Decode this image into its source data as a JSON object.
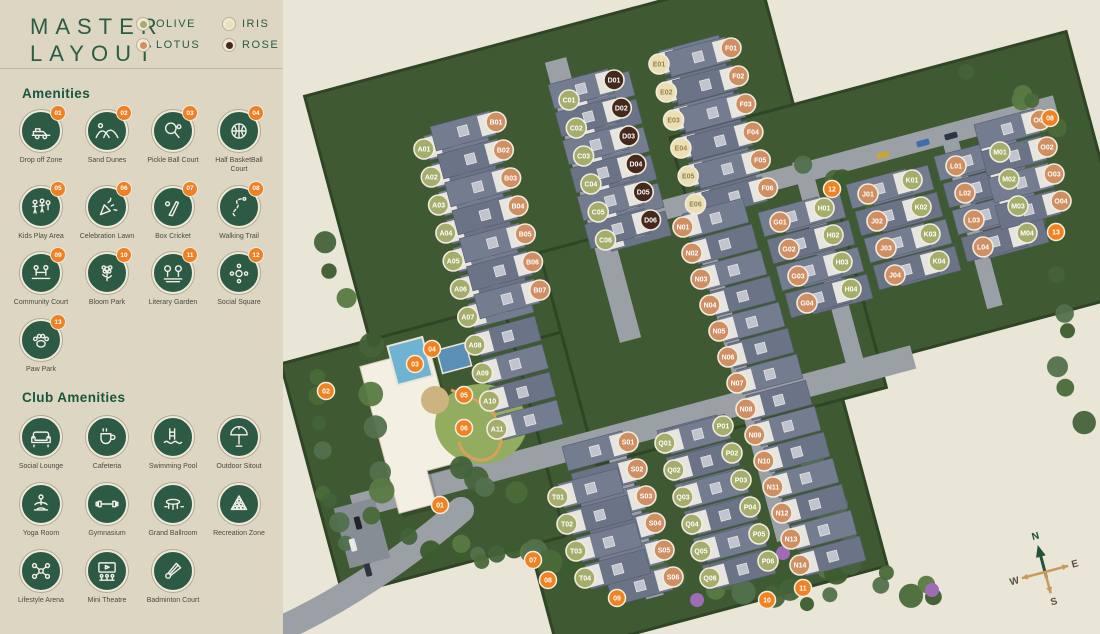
{
  "title": {
    "line1": "MASTER",
    "line2": "LAYOUT"
  },
  "legend": {
    "items": [
      {
        "label": "OLIVE",
        "color": "#a4ad6b"
      },
      {
        "label": "IRIS",
        "color": "#ecdfb4"
      },
      {
        "label": "LOTUS",
        "color": "#cf8f63"
      },
      {
        "label": "ROSE",
        "color": "#45291c"
      }
    ]
  },
  "amenities": {
    "heading": "Amenities",
    "items": [
      {
        "num": "01",
        "label": "Drop off Zone",
        "icon": "car"
      },
      {
        "num": "02",
        "label": "Sand Dunes",
        "icon": "dunes"
      },
      {
        "num": "03",
        "label": "Pickle Ball Court",
        "icon": "paddle"
      },
      {
        "num": "04",
        "label": "Half BasketBall Court",
        "icon": "basketball"
      },
      {
        "num": "05",
        "label": "Kids Play Area",
        "icon": "kids"
      },
      {
        "num": "06",
        "label": "Celebration Lawn",
        "icon": "party"
      },
      {
        "num": "07",
        "label": "Box Cricket",
        "icon": "cricket"
      },
      {
        "num": "08",
        "label": "Walking Trail",
        "icon": "trail"
      },
      {
        "num": "09",
        "label": "Community Court",
        "icon": "community"
      },
      {
        "num": "10",
        "label": "Bloom Park",
        "icon": "flower"
      },
      {
        "num": "11",
        "label": "Literary Garden",
        "icon": "garden"
      },
      {
        "num": "12",
        "label": "Social Square",
        "icon": "social"
      },
      {
        "num": "13",
        "label": "Paw Park",
        "icon": "paw"
      }
    ]
  },
  "club_amenities": {
    "heading": "Club Amenities",
    "items": [
      {
        "label": "Social Lounge",
        "icon": "sofa"
      },
      {
        "label": "Cafeteria",
        "icon": "cafe"
      },
      {
        "label": "Swimming Pool",
        "icon": "pool"
      },
      {
        "label": "Outdoor Sitout",
        "icon": "umbrella"
      },
      {
        "label": "Yoga Room",
        "icon": "yoga"
      },
      {
        "label": "Gymnasium",
        "icon": "dumbbell"
      },
      {
        "label": "Grand Ballroom",
        "icon": "ballroom"
      },
      {
        "label": "Recreation Zone",
        "icon": "billiards"
      },
      {
        "label": "Lifestyle Arena",
        "icon": "nodes"
      },
      {
        "label": "Mini Theatre",
        "icon": "theatre"
      },
      {
        "label": "Badminton Court",
        "icon": "shuttle"
      }
    ]
  },
  "map": {
    "background": "#e9e5d7",
    "unit_colors": {
      "olive": "#a4ad6b",
      "lotus": "#cf8f63",
      "iris": "#ecdfb4",
      "rose": "#45291c"
    },
    "clusters": [
      {
        "id": "A",
        "color": "olive",
        "count": 11,
        "x": 141,
        "y": 149,
        "dx": 7.3,
        "dy": 28,
        "side": 1
      },
      {
        "id": "B",
        "color": "lotus",
        "count": 7,
        "x": 213,
        "y": 122,
        "dx": 7.3,
        "dy": 28,
        "side": -1
      },
      {
        "id": "C",
        "color": "olive",
        "count": 6,
        "x": 286,
        "y": 100,
        "dx": 7.3,
        "dy": 28,
        "side": 1
      },
      {
        "id": "D",
        "color": "rose",
        "count": 6,
        "x": 331,
        "y": 80,
        "dx": 7.3,
        "dy": 28,
        "side": -1
      },
      {
        "id": "E",
        "color": "iris",
        "count": 6,
        "x": 376,
        "y": 64,
        "dx": 7.3,
        "dy": 28,
        "side": 1
      },
      {
        "id": "F",
        "color": "lotus",
        "count": 6,
        "x": 448,
        "y": 48,
        "dx": 7.3,
        "dy": 28,
        "side": -1
      },
      {
        "id": "G",
        "color": "lotus",
        "count": 4,
        "x": 497,
        "y": 222,
        "dx": 9,
        "dy": 27,
        "side": 1
      },
      {
        "id": "H",
        "color": "olive",
        "count": 4,
        "x": 541,
        "y": 208,
        "dx": 9,
        "dy": 27,
        "side": -1
      },
      {
        "id": "J",
        "color": "lotus",
        "count": 4,
        "x": 585,
        "y": 194,
        "dx": 9,
        "dy": 27,
        "side": 1
      },
      {
        "id": "K",
        "color": "olive",
        "count": 4,
        "x": 629,
        "y": 180,
        "dx": 9,
        "dy": 27,
        "side": -1
      },
      {
        "id": "L",
        "color": "lotus",
        "count": 4,
        "x": 673,
        "y": 166,
        "dx": 9,
        "dy": 27,
        "side": 1
      },
      {
        "id": "M",
        "color": "olive",
        "count": 4,
        "x": 717,
        "y": 152,
        "dx": 9,
        "dy": 27,
        "side": -1
      },
      {
        "id": "O",
        "color": "lotus",
        "count": 4,
        "x": 757,
        "y": 120,
        "dx": 7,
        "dy": 27,
        "side": -1
      },
      {
        "id": "N",
        "color": "lotus",
        "count": 14,
        "x": 400,
        "y": 227,
        "dx": 9,
        "dy": 26,
        "side": 1
      },
      {
        "id": "P",
        "color": "olive",
        "count": 6,
        "x": 440,
        "y": 426,
        "dx": 9,
        "dy": 27,
        "side": -1
      },
      {
        "id": "Q",
        "color": "olive",
        "count": 6,
        "x": 382,
        "y": 443,
        "dx": 9,
        "dy": 27,
        "side": 1
      },
      {
        "id": "S",
        "color": "lotus",
        "count": 6,
        "x": 345,
        "y": 442,
        "dx": 9,
        "dy": 27,
        "side": -1
      },
      {
        "id": "T",
        "color": "olive",
        "count": 4,
        "x": 275,
        "y": 497,
        "dx": 9,
        "dy": 27,
        "side": 1
      }
    ],
    "markers": [
      {
        "num": "01",
        "x": 157,
        "y": 505
      },
      {
        "num": "02",
        "x": 43,
        "y": 391
      },
      {
        "num": "03",
        "x": 132,
        "y": 364
      },
      {
        "num": "04",
        "x": 149,
        "y": 349
      },
      {
        "num": "05",
        "x": 181,
        "y": 395
      },
      {
        "num": "06",
        "x": 181,
        "y": 428
      },
      {
        "num": "07",
        "x": 250,
        "y": 560
      },
      {
        "num": "08",
        "x": 265,
        "y": 580
      },
      {
        "num": "09",
        "x": 334,
        "y": 598
      },
      {
        "num": "10",
        "x": 484,
        "y": 600
      },
      {
        "num": "11",
        "x": 520,
        "y": 588
      },
      {
        "num": "12",
        "x": 549,
        "y": 189
      },
      {
        "num": "13",
        "x": 773,
        "y": 232
      },
      {
        "num": "08",
        "x": 767,
        "y": 118
      }
    ],
    "marker_color": "#ef8222",
    "compass": {
      "n": "N",
      "e": "E",
      "s": "S",
      "w": "W"
    }
  }
}
